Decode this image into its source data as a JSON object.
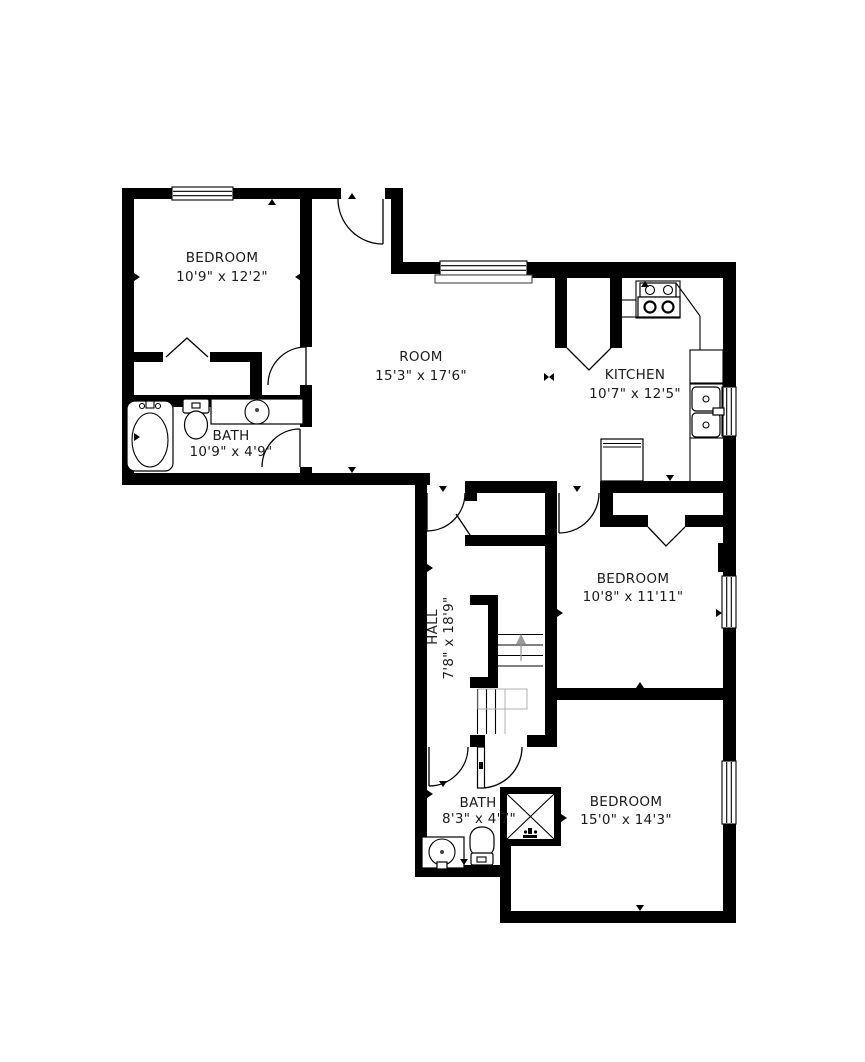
{
  "floorplan": {
    "background": "#ffffff",
    "wall_color": "#000000",
    "text_color": "#1b1b1b",
    "rooms": [
      {
        "id": "bedroom-top-left",
        "name": "BEDROOM",
        "dims": "10'9\" x 12'2\""
      },
      {
        "id": "room-center",
        "name": "ROOM",
        "dims": "15'3\" x 17'6\""
      },
      {
        "id": "kitchen",
        "name": "KITCHEN",
        "dims": "10'7\" x 12'5\""
      },
      {
        "id": "bath-left",
        "name": "BATH",
        "dims": "10'9\" x 4'9\""
      },
      {
        "id": "hall",
        "name": "HALL",
        "dims": "7'8\" x 18'9\""
      },
      {
        "id": "bedroom-middle",
        "name": "BEDROOM",
        "dims": "10'8\" x 11'11\""
      },
      {
        "id": "bath-bottom",
        "name": "BATH",
        "dims": "8'3\" x 4'7\""
      },
      {
        "id": "bedroom-bottom",
        "name": "BEDROOM",
        "dims": "15'0\" x 14'3\""
      }
    ],
    "fixtures": [
      "bathtub",
      "toilet",
      "vanity-sink",
      "stove",
      "kitchen-sink",
      "refrigerator",
      "shower",
      "stairs"
    ]
  }
}
